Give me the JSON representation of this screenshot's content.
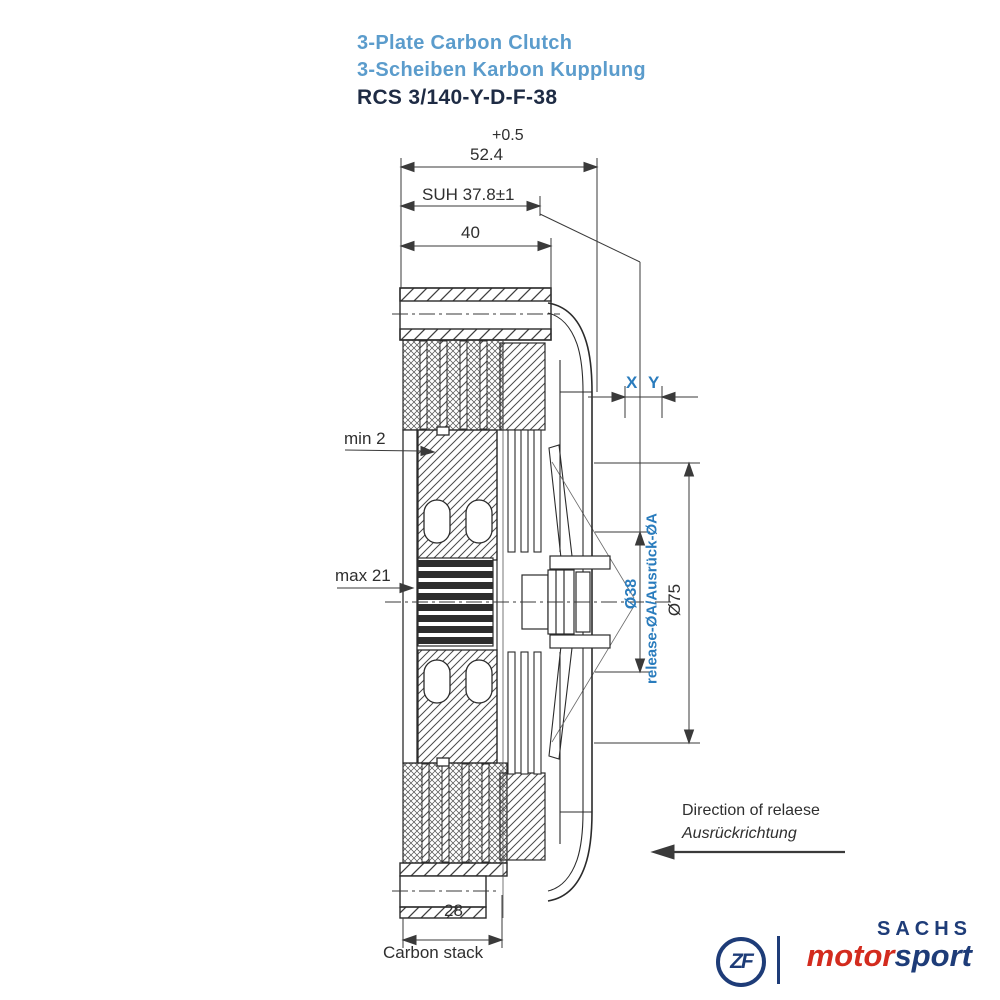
{
  "title": {
    "product_en": "3-Plate Carbon Clutch",
    "product_de": "3-Scheiben Karbon Kupplung",
    "model": "RCS 3/140-Y-D-F-38"
  },
  "dimensions": {
    "tolerance": "+0.5",
    "overall_depth": "52.4",
    "suh": "SUH 37.8±1",
    "cover_depth": "40",
    "x": "X",
    "y": "Y",
    "min_wear": "min 2",
    "max_wear": "max 21",
    "release_dia": "Ø38",
    "release_dia_label": "release-ØA/Ausrück-ØA",
    "bearing_outer_dia": "Ø75",
    "carbon_stack_width": "28",
    "carbon_stack_label": "Carbon stack"
  },
  "notes": {
    "release_direction_en": "Direction of relaese",
    "release_direction_de": "Ausrückrichtung"
  },
  "branding": {
    "zf_monogram": "ZF",
    "sachs": "SACHS",
    "motorsport_prefix": "motor",
    "motorsport_suffix": "sport"
  },
  "colors": {
    "title_blue": "#5b9ccc",
    "dimension_blue": "#2a7cbd",
    "brand_navy": "#1e3c78",
    "brand_red": "#d32b1e",
    "line_dark": "#2b2b2b"
  }
}
